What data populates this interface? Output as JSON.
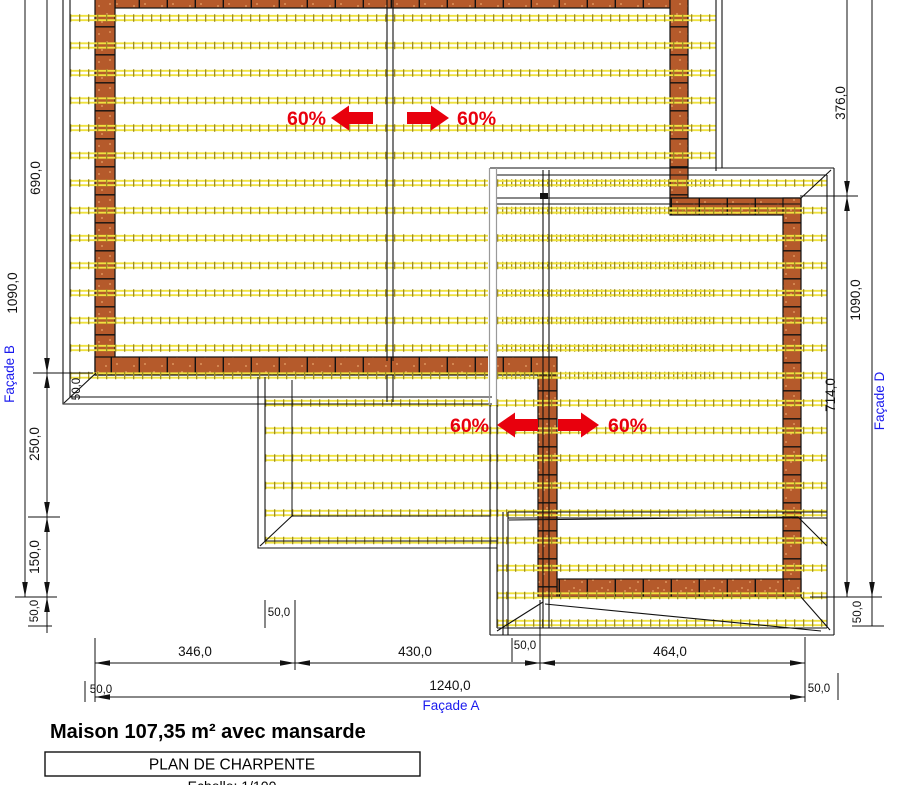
{
  "title": "Maison 107,35 m² avec mansarde",
  "cartouche": {
    "plan": "PLAN DE CHARPENTE",
    "scale": "Echelle: 1/100"
  },
  "labels": {
    "slope": "60%",
    "facade_a": "Façade A",
    "facade_b": "Façade B",
    "facade_d": "Façade D"
  },
  "dimensions": {
    "d690": "690,0",
    "d1090": "1090,0",
    "d250": "250,0",
    "d150": "150,0",
    "d376": "376,0",
    "d714": "714,0",
    "d346": "346,0",
    "d430": "430,0",
    "d464": "464,0",
    "d1240": "1240,0",
    "d50": "50,0"
  },
  "colors": {
    "wall": "#B55A2B",
    "wall_dot": "#E9A46B",
    "batten": "#EFE23F",
    "batten_tick": "#9C8A24",
    "slope_arrow": "#E8000D",
    "facade_label": "#1A1AEE"
  }
}
